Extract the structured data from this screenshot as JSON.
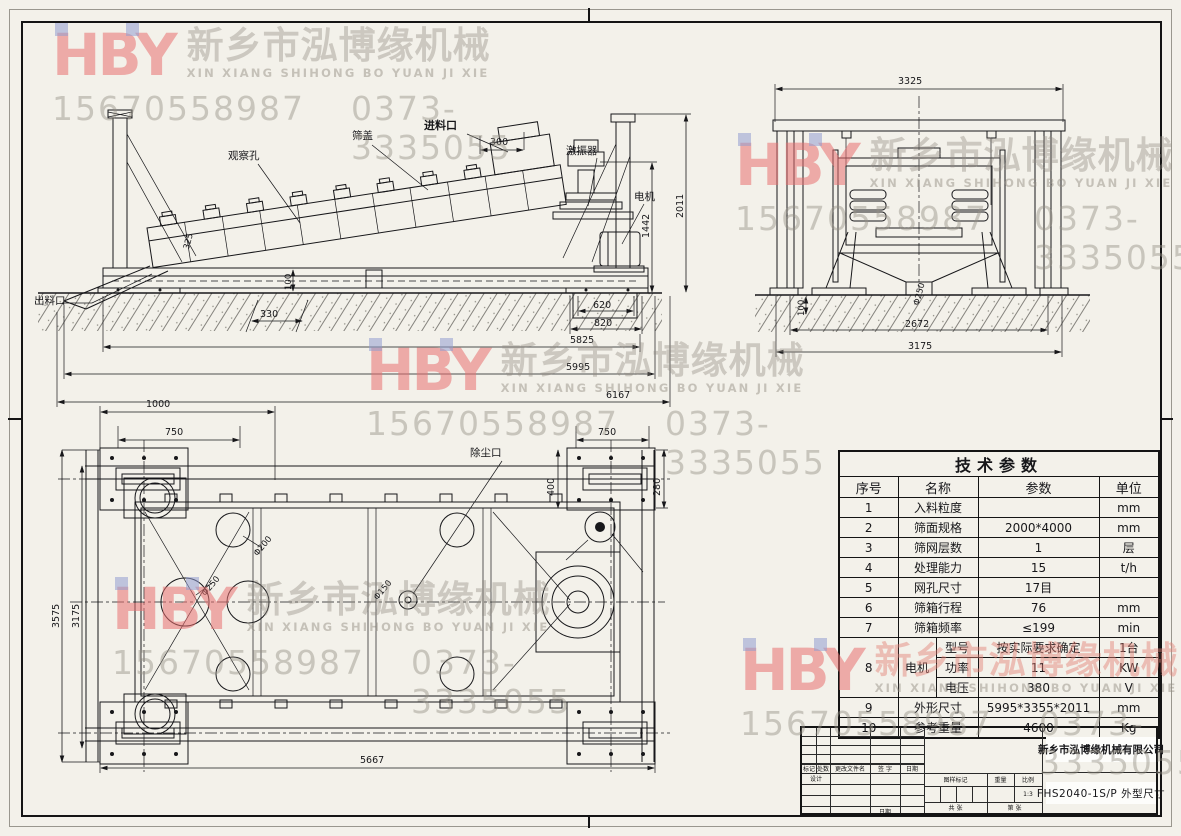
{
  "watermark": {
    "logo": "HBY",
    "company_cn": "新乡市泓博缘机械",
    "company_en": "XIN XIANG SHIHONG BO YUAN JI XIE",
    "phone_mobile": "15670558987",
    "phone_tel": "0373-3335055",
    "logo_color": "#e77070",
    "accent_square_color": "#929cd0"
  },
  "side_view": {
    "labels": {
      "observation_hole": "观察孔",
      "screen_cover": "筛盖",
      "feed_inlet": "进料口",
      "exciter": "激振器",
      "motor": "电机",
      "discharge_outlet": "出料口"
    },
    "dims": {
      "feed_opening": "300",
      "box_end_height": "325",
      "base_height": "100",
      "foot_offset": "330",
      "pit_inner": "620",
      "pit_outer": "820",
      "base_span": "5825",
      "frame_length": "5995",
      "total_length": "6167",
      "motor_height": "1442",
      "total_height": "2011"
    }
  },
  "end_view": {
    "dims": {
      "top_width": "3325",
      "outlet_dia": "Φ250",
      "base_height": "100",
      "leg_span": "2672",
      "base_width": "3175"
    }
  },
  "top_view": {
    "labels": {
      "dust_port": "除尘口"
    },
    "dims": {
      "pad_span": "1000",
      "left_bolt_span": "750",
      "right_bolt_span": "750",
      "pad_width": "400",
      "pad_height": "280",
      "hole_250": "Φ250",
      "hole_200": "Φ200",
      "hole_150": "Φ150",
      "width_overall": "3575",
      "width_frame": "3175",
      "length_pads": "5667"
    }
  },
  "table": {
    "title": "技术参数",
    "headers": [
      "序号",
      "名称",
      "参数",
      "单位"
    ],
    "rows": [
      {
        "no": "1",
        "name": "入料粒度",
        "value": "",
        "unit": "mm"
      },
      {
        "no": "2",
        "name": "筛面规格",
        "value": "2000*4000",
        "unit": "mm"
      },
      {
        "no": "3",
        "name": "筛网层数",
        "value": "1",
        "unit": "层"
      },
      {
        "no": "4",
        "name": "处理能力",
        "value": "15",
        "unit": "t/h"
      },
      {
        "no": "5",
        "name": "网孔尺寸",
        "value": "17目",
        "unit": ""
      },
      {
        "no": "6",
        "name": "筛箱行程",
        "value": "76",
        "unit": "mm"
      },
      {
        "no": "7",
        "name": "筛箱频率",
        "value": "≤199",
        "unit": "min"
      }
    ],
    "motor": {
      "no": "8",
      "name": "电机",
      "subs": [
        {
          "param": "型号",
          "value": "按实际要求确定",
          "unit": "1台"
        },
        {
          "param": "功率",
          "value": "11",
          "unit": "KW"
        },
        {
          "param": "电压",
          "value": "380",
          "unit": "V"
        }
      ]
    },
    "row9": {
      "no": "9",
      "name": "外形尺寸",
      "value": "5995*3355*2011",
      "unit": "mm"
    },
    "row10": {
      "no": "10",
      "name": "参考重量",
      "value": "4600",
      "unit": "Kg"
    }
  },
  "title_block": {
    "company": "新乡市泓博缘机械有限公司",
    "drawing_no": "FHS2040-1S/P  外型尺寸",
    "labels": {
      "mark": "标记",
      "count": "处数",
      "file": "更改文件名",
      "sign": "签 字",
      "date": "日期",
      "design": "设计",
      "date2": "日期",
      "drawing_mark": "图样标记",
      "weight": "重量",
      "scale": "比例",
      "scale_val": "1:3",
      "sheets": "共 张",
      "page": "第 张"
    }
  }
}
